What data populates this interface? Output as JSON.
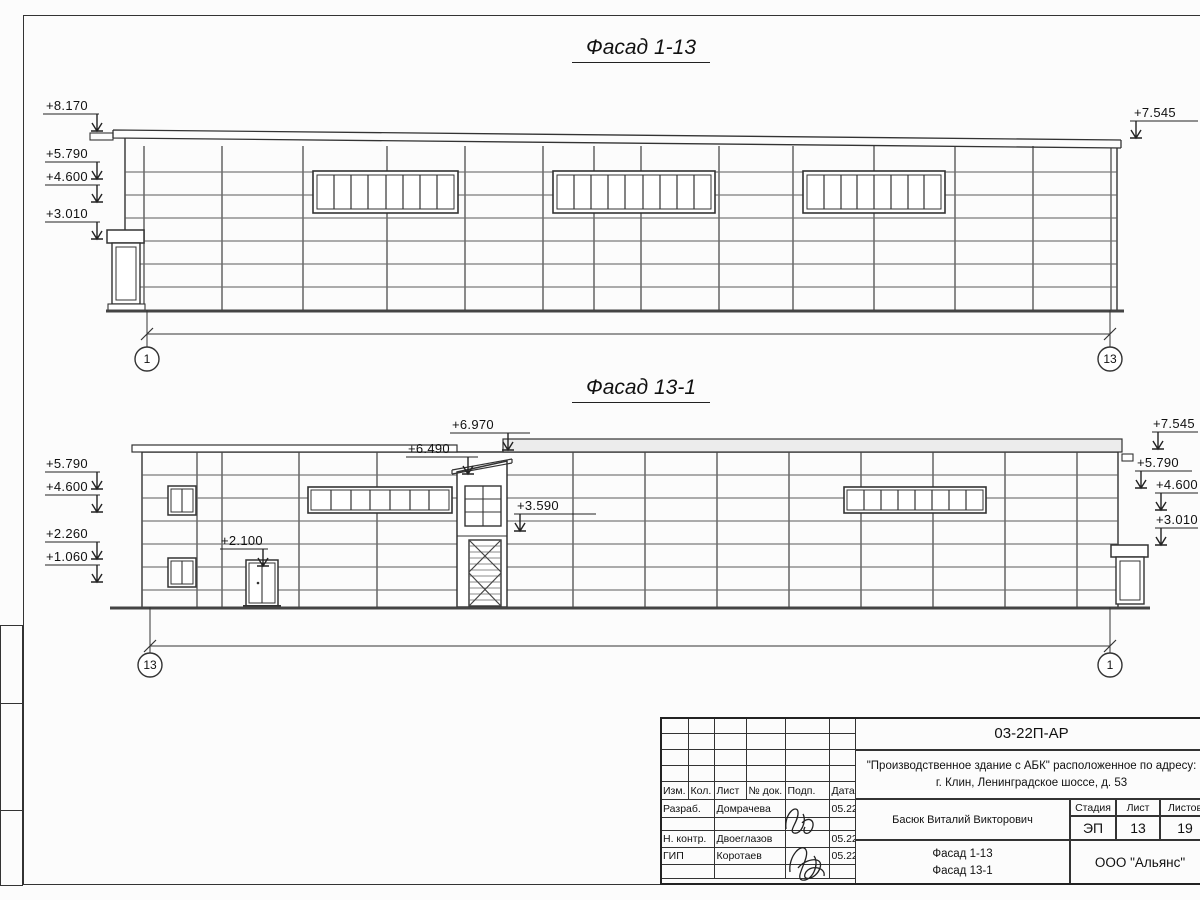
{
  "drawing": {
    "facade1": {
      "title": "Фасад 1-13",
      "axis_left": "1",
      "axis_right": "13",
      "marks_left": [
        "+8.170",
        "+5.790",
        "+4.600",
        "+3.010"
      ],
      "marks_right": [
        "+7.545"
      ]
    },
    "facade2": {
      "title": "Фасад 13-1",
      "axis_left": "13",
      "axis_right": "1",
      "marks_left": [
        "+5.790",
        "+4.600",
        "+2.260",
        "+1.060"
      ],
      "marks_right": [
        "+7.545",
        "+5.790",
        "+4.600",
        "+3.010"
      ],
      "marks_inner": [
        "+6.970",
        "+6.490",
        "+3.590",
        "+2.100"
      ]
    }
  },
  "titleblock": {
    "doc_code": "03-22П-АР",
    "project_line1": "\"Производственное здание с АБК\" расположенное по адресу:",
    "project_line2": "г. Клин, Ленинградское шоссе, д. 53",
    "columns": [
      "Изм.",
      "Кол.",
      "Лист",
      "№ док.",
      "Подп.",
      "Дата"
    ],
    "staff": [
      {
        "role": "Разраб.",
        "name": "Домрачева",
        "date": "05.22"
      },
      {
        "role": "Н. контр.",
        "name": "Двоеглазов",
        "date": "05.22"
      },
      {
        "role": "ГИП",
        "name": "Коротаев",
        "date": "05.22"
      }
    ],
    "client": "Басюк Виталий Викторович",
    "stage_label": "Стадия",
    "sheet_label": "Лист",
    "sheets_label": "Листов",
    "stage": "ЭП",
    "sheet_number": "13",
    "sheets_total": "19",
    "drawing_title_line1": "Фасад 1-13",
    "drawing_title_line2": "Фасад 13-1",
    "company": "ООО \"Альянс\""
  }
}
